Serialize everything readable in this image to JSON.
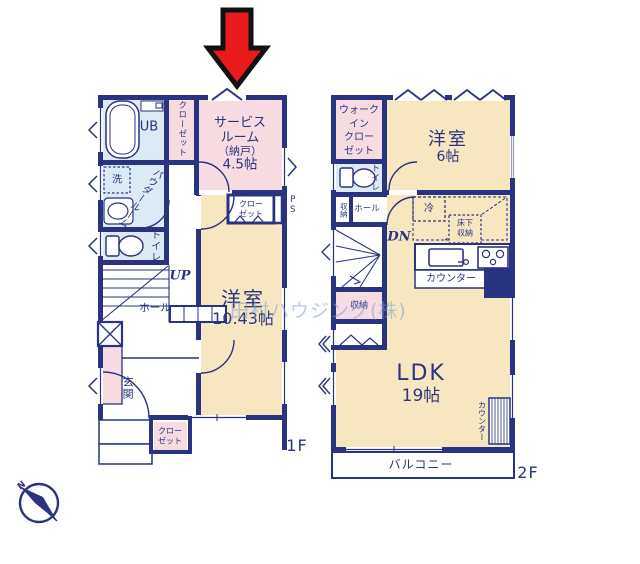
{
  "colors": {
    "wall_navy": "#29337f",
    "room_cream": "#f6e7c1",
    "room_pink": "#f6dbe1",
    "room_blue": "#dceaf6",
    "arrow_red": "#e81a1c",
    "watermark_blue": "#7da2d4",
    "background": "#ffffff"
  },
  "watermark": {
    "text": "田村ハウジング(株)"
  },
  "compass": {
    "north_label": "N"
  },
  "floor1": {
    "floor_label": "1F",
    "rooms": {
      "unit_bath": "UB",
      "closet_top": "クローゼット",
      "service_room_l1": "サービス",
      "service_room_l2": "ルーム",
      "service_room_l3": "（納戸）",
      "service_room_l4": "4.5帖",
      "laundry": "洗",
      "powder_room_l1": "パウダー",
      "powder_room_l2": "ルーム",
      "toilet": "トイレ",
      "stairs": "UP",
      "hall": "ホール",
      "closet_mid_l1": "クロー",
      "closet_mid_l2": "ゼット",
      "pipe_space": "PS",
      "bedroom_name": "洋室",
      "bedroom_size": "10.43帖",
      "entrance": "玄関",
      "closet_bottom_l1": "クロー",
      "closet_bottom_l2": "ゼット"
    }
  },
  "floor2": {
    "floor_label": "2F",
    "rooms": {
      "wic_l1": "ウォーク",
      "wic_l2": "イン",
      "wic_l3": "クロー",
      "wic_l4": "ゼット",
      "bedroom_name": "洋室",
      "bedroom_size": "6帖",
      "toilet": "トイレ",
      "storage_upper": "収納",
      "hall": "ホール",
      "fridge": "冷",
      "stairs": "DN",
      "underfloor_l1": "床下",
      "underfloor_l2": "収納",
      "kitchen_counter": "カウンター",
      "storage_lower": "収納",
      "ldk_name": "LDK",
      "ldk_size": "19帖",
      "side_counter": "カウンター",
      "balcony": "バルコニー"
    }
  }
}
